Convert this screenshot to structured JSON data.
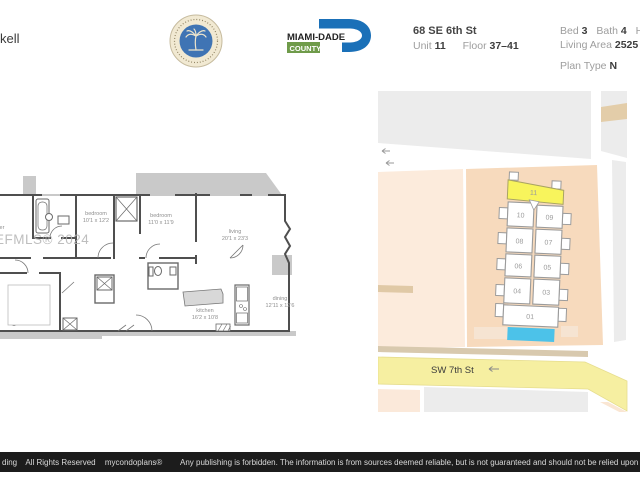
{
  "header": {
    "title_fragment": "kell",
    "county_logo": {
      "name": "MIAMI-DADE",
      "county": "COUNTY"
    },
    "address": "68 SE 6th St",
    "unit": {
      "label": "Unit",
      "value": "11"
    },
    "floor": {
      "label": "Floor",
      "value": "37–41"
    },
    "bed": {
      "label": "Bed",
      "value": "3"
    },
    "bath": {
      "label": "Bath",
      "value": "4"
    },
    "half": {
      "label": "Half",
      "value": "1"
    },
    "living_area": {
      "label": "Living Area",
      "value": "2525 sf 2"
    },
    "plan_type": {
      "label": "Plan Type",
      "value": "N"
    }
  },
  "floor_plan": {
    "watermark": "EFMLS® 2024",
    "rooms": [
      {
        "name": "master",
        "dims": ""
      },
      {
        "name": "bedroom",
        "dims": "10'1 x 12'2"
      },
      {
        "name": "bedroom",
        "dims": "11'0 x 11'9"
      },
      {
        "name": "living",
        "dims": "20'1 x 23'3"
      },
      {
        "name": "kitchen",
        "dims": "16'2 x 10'8"
      },
      {
        "name": "dining",
        "dims": "12'11 x 12'6"
      }
    ]
  },
  "site_map": {
    "street_label": "SW 7th St",
    "highlighted_unit": "11",
    "units": [
      "11",
      "10",
      "09",
      "08",
      "07",
      "06",
      "05",
      "04",
      "03",
      "01"
    ],
    "colors": {
      "highlight": "#f8f45c",
      "lot": "#f7dabd",
      "pool": "#4cc2e9",
      "street": "#f6efa1",
      "block": "#ececec"
    }
  },
  "footer": {
    "left_fragment": "ding",
    "rights": "All Rights Reserved",
    "brand": "mycondoplans®",
    "disclaimer": "Any publishing is forbidden.  The information is from sources deemed reliable, but is not guaranteed and should not be relied upon without"
  }
}
